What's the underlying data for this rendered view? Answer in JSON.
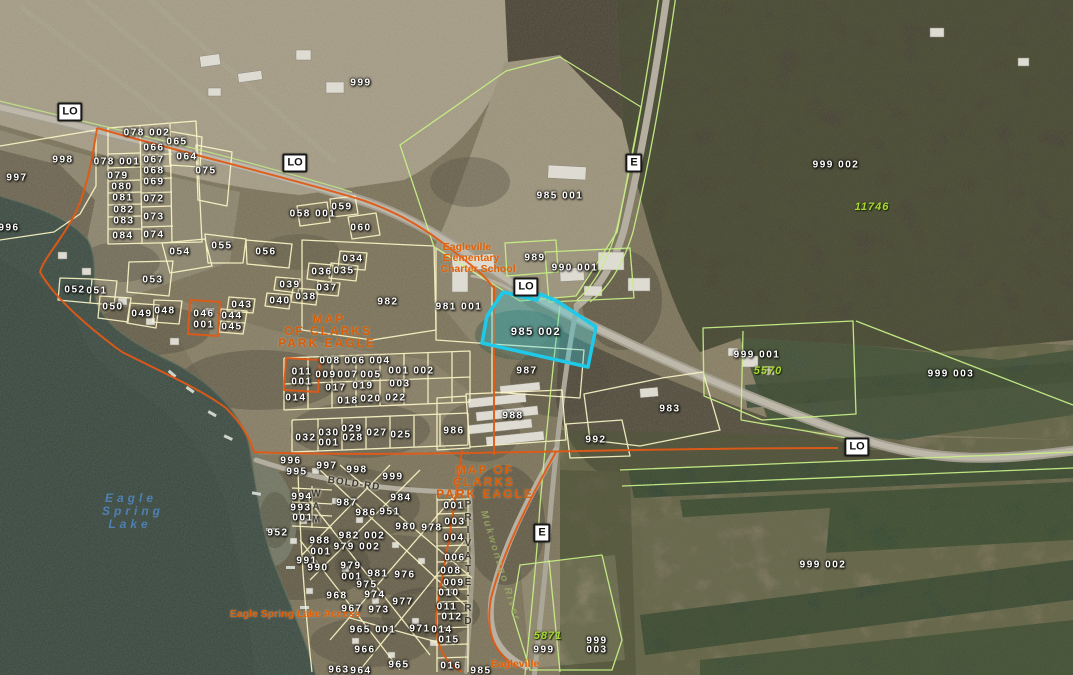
{
  "map": {
    "selected_parcel": "985 002",
    "colors": {
      "selection": "#1fc9e8",
      "plat_boundary": "#e05a17",
      "parcel_line": "#fdf8c8",
      "parcel_line_alt": "#c6ef86",
      "parcel_text": "#ffffff",
      "address_text": "#a8d832",
      "plat_text": "#d95c06",
      "place_text": "#e06008",
      "water_text": "#4e80b2"
    },
    "shields": [
      {
        "t": "LO",
        "x": 70,
        "y": 112
      },
      {
        "t": "LO",
        "x": 295,
        "y": 163
      },
      {
        "t": "LO",
        "x": 526,
        "y": 287
      },
      {
        "t": "LO",
        "x": 857,
        "y": 447
      },
      {
        "t": "E",
        "x": 634,
        "y": 163
      },
      {
        "t": "E",
        "x": 542,
        "y": 533
      }
    ],
    "labels": [
      {
        "t": "999",
        "x": 361,
        "y": 83,
        "k": "p"
      },
      {
        "t": "998",
        "x": 63,
        "y": 160,
        "k": "p"
      },
      {
        "t": "997",
        "x": 17,
        "y": 178,
        "k": "p"
      },
      {
        "t": "996",
        "x": 9,
        "y": 228,
        "k": "p"
      },
      {
        "t": "078 002",
        "x": 147,
        "y": 133,
        "k": "p"
      },
      {
        "t": "078 001",
        "x": 117,
        "y": 162,
        "k": "p"
      },
      {
        "t": "066",
        "x": 154,
        "y": 148,
        "k": "p"
      },
      {
        "t": "065",
        "x": 177,
        "y": 142,
        "k": "p"
      },
      {
        "t": "067",
        "x": 154,
        "y": 160,
        "k": "p"
      },
      {
        "t": "064",
        "x": 187,
        "y": 157,
        "k": "p"
      },
      {
        "t": "075",
        "x": 206,
        "y": 171,
        "k": "p"
      },
      {
        "t": "079",
        "x": 118,
        "y": 176,
        "k": "p"
      },
      {
        "t": "068",
        "x": 154,
        "y": 171,
        "k": "p"
      },
      {
        "t": "080",
        "x": 122,
        "y": 187,
        "k": "p"
      },
      {
        "t": "069",
        "x": 154,
        "y": 182,
        "k": "p"
      },
      {
        "t": "081",
        "x": 123,
        "y": 198,
        "k": "p"
      },
      {
        "t": "072",
        "x": 154,
        "y": 199,
        "k": "p"
      },
      {
        "t": "082",
        "x": 124,
        "y": 210,
        "k": "p"
      },
      {
        "t": "083",
        "x": 124,
        "y": 221,
        "k": "p"
      },
      {
        "t": "073",
        "x": 154,
        "y": 217,
        "k": "p"
      },
      {
        "t": "084",
        "x": 123,
        "y": 236,
        "k": "p"
      },
      {
        "t": "074",
        "x": 154,
        "y": 235,
        "k": "p"
      },
      {
        "t": "054",
        "x": 180,
        "y": 252,
        "k": "p"
      },
      {
        "t": "055",
        "x": 222,
        "y": 246,
        "k": "p"
      },
      {
        "t": "056",
        "x": 266,
        "y": 252,
        "k": "p"
      },
      {
        "t": "053",
        "x": 153,
        "y": 280,
        "k": "p"
      },
      {
        "t": "052",
        "x": 75,
        "y": 290,
        "k": "p"
      },
      {
        "t": "051",
        "x": 97,
        "y": 291,
        "k": "p"
      },
      {
        "t": "050",
        "x": 113,
        "y": 307,
        "k": "p"
      },
      {
        "t": "049",
        "x": 142,
        "y": 314,
        "k": "p"
      },
      {
        "t": "048",
        "x": 165,
        "y": 311,
        "k": "p"
      },
      {
        "t": "046",
        "x": 204,
        "y": 314,
        "k": "p"
      },
      {
        "t": "001",
        "x": 204,
        "y": 325,
        "k": "p"
      },
      {
        "t": "043",
        "x": 242,
        "y": 305,
        "k": "p"
      },
      {
        "t": "044",
        "x": 232,
        "y": 316,
        "k": "p"
      },
      {
        "t": "045",
        "x": 232,
        "y": 327,
        "k": "p"
      },
      {
        "t": "040",
        "x": 280,
        "y": 301,
        "k": "p"
      },
      {
        "t": "038",
        "x": 306,
        "y": 297,
        "k": "p"
      },
      {
        "t": "039",
        "x": 290,
        "y": 285,
        "k": "p"
      },
      {
        "t": "058 001",
        "x": 313,
        "y": 214,
        "k": "p"
      },
      {
        "t": "059",
        "x": 342,
        "y": 207,
        "k": "p"
      },
      {
        "t": "060",
        "x": 361,
        "y": 228,
        "k": "p"
      },
      {
        "t": "034",
        "x": 353,
        "y": 259,
        "k": "p"
      },
      {
        "t": "036",
        "x": 322,
        "y": 272,
        "k": "p"
      },
      {
        "t": "035",
        "x": 344,
        "y": 271,
        "k": "p"
      },
      {
        "t": "037",
        "x": 327,
        "y": 288,
        "k": "p"
      },
      {
        "t": "982",
        "x": 388,
        "y": 302,
        "k": "p"
      },
      {
        "t": "981 001",
        "x": 459,
        "y": 307,
        "k": "p"
      },
      {
        "t": "985 002",
        "x": 536,
        "y": 332,
        "k": "s"
      },
      {
        "t": "987",
        "x": 527,
        "y": 371,
        "k": "p"
      },
      {
        "t": "988",
        "x": 513,
        "y": 416,
        "k": "p"
      },
      {
        "t": "986",
        "x": 454,
        "y": 431,
        "k": "p"
      },
      {
        "t": "992",
        "x": 596,
        "y": 440,
        "k": "p"
      },
      {
        "t": "983",
        "x": 670,
        "y": 409,
        "k": "p"
      },
      {
        "t": "985 001",
        "x": 560,
        "y": 196,
        "k": "p"
      },
      {
        "t": "989",
        "x": 535,
        "y": 258,
        "k": "p"
      },
      {
        "t": "990 001",
        "x": 575,
        "y": 268,
        "k": "p"
      },
      {
        "t": "999 002",
        "x": 836,
        "y": 165,
        "k": "p"
      },
      {
        "t": "11746",
        "x": 872,
        "y": 207,
        "k": "a"
      },
      {
        "t": "999 001",
        "x": 757,
        "y": 355,
        "k": "p"
      },
      {
        "t": "5570",
        "x": 768,
        "y": 371,
        "k": "a"
      },
      {
        "t": "999 003",
        "x": 951,
        "y": 374,
        "k": "p"
      },
      {
        "t": "999 002",
        "x": 823,
        "y": 565,
        "k": "p"
      },
      {
        "t": "952",
        "x": 278,
        "y": 533,
        "k": "p"
      },
      {
        "t": "008",
        "x": 330,
        "y": 361,
        "k": "p"
      },
      {
        "t": "006",
        "x": 355,
        "y": 361,
        "k": "p"
      },
      {
        "t": "004",
        "x": 380,
        "y": 361,
        "k": "p"
      },
      {
        "t": "011",
        "x": 302,
        "y": 372,
        "k": "p"
      },
      {
        "t": "001",
        "x": 302,
        "y": 382,
        "k": "p"
      },
      {
        "t": "009",
        "x": 326,
        "y": 375,
        "k": "p"
      },
      {
        "t": "007",
        "x": 348,
        "y": 375,
        "k": "p"
      },
      {
        "t": "005",
        "x": 371,
        "y": 375,
        "k": "p"
      },
      {
        "t": "001",
        "x": 399,
        "y": 371,
        "k": "p"
      },
      {
        "t": "002",
        "x": 424,
        "y": 371,
        "k": "p"
      },
      {
        "t": "017",
        "x": 336,
        "y": 388,
        "k": "p"
      },
      {
        "t": "019",
        "x": 363,
        "y": 386,
        "k": "p"
      },
      {
        "t": "003",
        "x": 400,
        "y": 384,
        "k": "p"
      },
      {
        "t": "014",
        "x": 296,
        "y": 398,
        "k": "p"
      },
      {
        "t": "018",
        "x": 348,
        "y": 401,
        "k": "p"
      },
      {
        "t": "020",
        "x": 371,
        "y": 399,
        "k": "p"
      },
      {
        "t": "022",
        "x": 396,
        "y": 398,
        "k": "p"
      },
      {
        "t": "032",
        "x": 306,
        "y": 438,
        "k": "p"
      },
      {
        "t": "030",
        "x": 329,
        "y": 433,
        "k": "p"
      },
      {
        "t": "001",
        "x": 329,
        "y": 443,
        "k": "p"
      },
      {
        "t": "029",
        "x": 352,
        "y": 429,
        "k": "p"
      },
      {
        "t": "028",
        "x": 353,
        "y": 438,
        "k": "p"
      },
      {
        "t": "027",
        "x": 377,
        "y": 433,
        "k": "p"
      },
      {
        "t": "025",
        "x": 401,
        "y": 435,
        "k": "p"
      },
      {
        "t": "996",
        "x": 291,
        "y": 461,
        "k": "p"
      },
      {
        "t": "997",
        "x": 327,
        "y": 466,
        "k": "p"
      },
      {
        "t": "995",
        "x": 297,
        "y": 472,
        "k": "p"
      },
      {
        "t": "998",
        "x": 357,
        "y": 470,
        "k": "p"
      },
      {
        "t": "999",
        "x": 393,
        "y": 477,
        "k": "p"
      },
      {
        "t": "994",
        "x": 302,
        "y": 497,
        "k": "p"
      },
      {
        "t": "993",
        "x": 301,
        "y": 508,
        "k": "p"
      },
      {
        "t": "001",
        "x": 303,
        "y": 518,
        "k": "p"
      },
      {
        "t": "987",
        "x": 347,
        "y": 503,
        "k": "p"
      },
      {
        "t": "986",
        "x": 366,
        "y": 513,
        "k": "p"
      },
      {
        "t": "951",
        "x": 390,
        "y": 512,
        "k": "p"
      },
      {
        "t": "984",
        "x": 401,
        "y": 498,
        "k": "p"
      },
      {
        "t": "988",
        "x": 320,
        "y": 541,
        "k": "p"
      },
      {
        "t": "001",
        "x": 321,
        "y": 552,
        "k": "p"
      },
      {
        "t": "982 002",
        "x": 362,
        "y": 536,
        "k": "p"
      },
      {
        "t": "980",
        "x": 406,
        "y": 527,
        "k": "p"
      },
      {
        "t": "978",
        "x": 432,
        "y": 528,
        "k": "p"
      },
      {
        "t": "979 002",
        "x": 357,
        "y": 547,
        "k": "p"
      },
      {
        "t": "991",
        "x": 307,
        "y": 561,
        "k": "p"
      },
      {
        "t": "990",
        "x": 318,
        "y": 568,
        "k": "p"
      },
      {
        "t": "979",
        "x": 351,
        "y": 566,
        "k": "p"
      },
      {
        "t": "001",
        "x": 352,
        "y": 577,
        "k": "p"
      },
      {
        "t": "981",
        "x": 378,
        "y": 574,
        "k": "p"
      },
      {
        "t": "976",
        "x": 405,
        "y": 575,
        "k": "p"
      },
      {
        "t": "975",
        "x": 367,
        "y": 585,
        "k": "p"
      },
      {
        "t": "968",
        "x": 337,
        "y": 596,
        "k": "p"
      },
      {
        "t": "974",
        "x": 375,
        "y": 595,
        "k": "p"
      },
      {
        "t": "977",
        "x": 403,
        "y": 602,
        "k": "p"
      },
      {
        "t": "967",
        "x": 352,
        "y": 609,
        "k": "p"
      },
      {
        "t": "973",
        "x": 379,
        "y": 610,
        "k": "p"
      },
      {
        "t": "965 001",
        "x": 373,
        "y": 630,
        "k": "p"
      },
      {
        "t": "971",
        "x": 420,
        "y": 629,
        "k": "p"
      },
      {
        "t": "014",
        "x": 442,
        "y": 630,
        "k": "p"
      },
      {
        "t": "966",
        "x": 365,
        "y": 650,
        "k": "p"
      },
      {
        "t": "965",
        "x": 399,
        "y": 665,
        "k": "p"
      },
      {
        "t": "963",
        "x": 339,
        "y": 670,
        "k": "p"
      },
      {
        "t": "964",
        "x": 361,
        "y": 671,
        "k": "p"
      },
      {
        "t": "001",
        "x": 454,
        "y": 506,
        "k": "p"
      },
      {
        "t": "003",
        "x": 455,
        "y": 522,
        "k": "p"
      },
      {
        "t": "004",
        "x": 454,
        "y": 538,
        "k": "p"
      },
      {
        "t": "006",
        "x": 455,
        "y": 558,
        "k": "p"
      },
      {
        "t": "008",
        "x": 451,
        "y": 571,
        "k": "p"
      },
      {
        "t": "009",
        "x": 454,
        "y": 583,
        "k": "p"
      },
      {
        "t": "010",
        "x": 449,
        "y": 593,
        "k": "p"
      },
      {
        "t": "011",
        "x": 447,
        "y": 607,
        "k": "p"
      },
      {
        "t": "012",
        "x": 452,
        "y": 617,
        "k": "p"
      },
      {
        "t": "015",
        "x": 449,
        "y": 640,
        "k": "p"
      },
      {
        "t": "016",
        "x": 451,
        "y": 666,
        "k": "p"
      },
      {
        "t": "985",
        "x": 481,
        "y": 671,
        "k": "p"
      },
      {
        "t": "999",
        "x": 544,
        "y": 650,
        "k": "p"
      },
      {
        "t": "999",
        "x": 597,
        "y": 641,
        "k": "p"
      },
      {
        "t": "003",
        "x": 597,
        "y": 650,
        "k": "p"
      },
      {
        "t": "5871",
        "x": 548,
        "y": 636,
        "k": "a"
      },
      {
        "t": "MAP",
        "x": 329,
        "y": 319,
        "k": "O"
      },
      {
        "t": "OF CLARKS",
        "x": 328,
        "y": 331,
        "k": "O"
      },
      {
        "t": "PARK EAGLE",
        "x": 327,
        "y": 343,
        "k": "O"
      },
      {
        "t": "MAP OF",
        "x": 485,
        "y": 470,
        "k": "O"
      },
      {
        "t": "CLARKS",
        "x": 484,
        "y": 482,
        "k": "O"
      },
      {
        "t": "PARK EAGLE",
        "x": 485,
        "y": 494,
        "k": "O"
      },
      {
        "t": "Eagleville",
        "x": 467,
        "y": 247,
        "k": "o"
      },
      {
        "t": "Elementary",
        "x": 471,
        "y": 258,
        "k": "o"
      },
      {
        "t": "Charter School",
        "x": 478,
        "y": 269,
        "k": "o"
      },
      {
        "t": "Eagle Spring Lake Access",
        "x": 295,
        "y": 614,
        "k": "o"
      },
      {
        "t": "Eagleville",
        "x": 515,
        "y": 664,
        "k": "o"
      },
      {
        "t": "Eagle",
        "x": 131,
        "y": 498,
        "k": "w"
      },
      {
        "t": "Spring",
        "x": 133,
        "y": 511,
        "k": "w"
      },
      {
        "t": "Lake",
        "x": 130,
        "y": 524,
        "k": "w"
      },
      {
        "t": "BOLD-RD",
        "x": 354,
        "y": 484,
        "k": "r",
        "r": 8
      },
      {
        "t": "WAM",
        "x": 316,
        "y": 508,
        "k": "rv"
      },
      {
        "t": "PRIVATE-RD",
        "x": 468,
        "y": 564,
        "k": "rv"
      },
      {
        "t": "Mukwonago River",
        "x": 500,
        "y": 566,
        "k": "v",
        "r": 73
      }
    ]
  }
}
